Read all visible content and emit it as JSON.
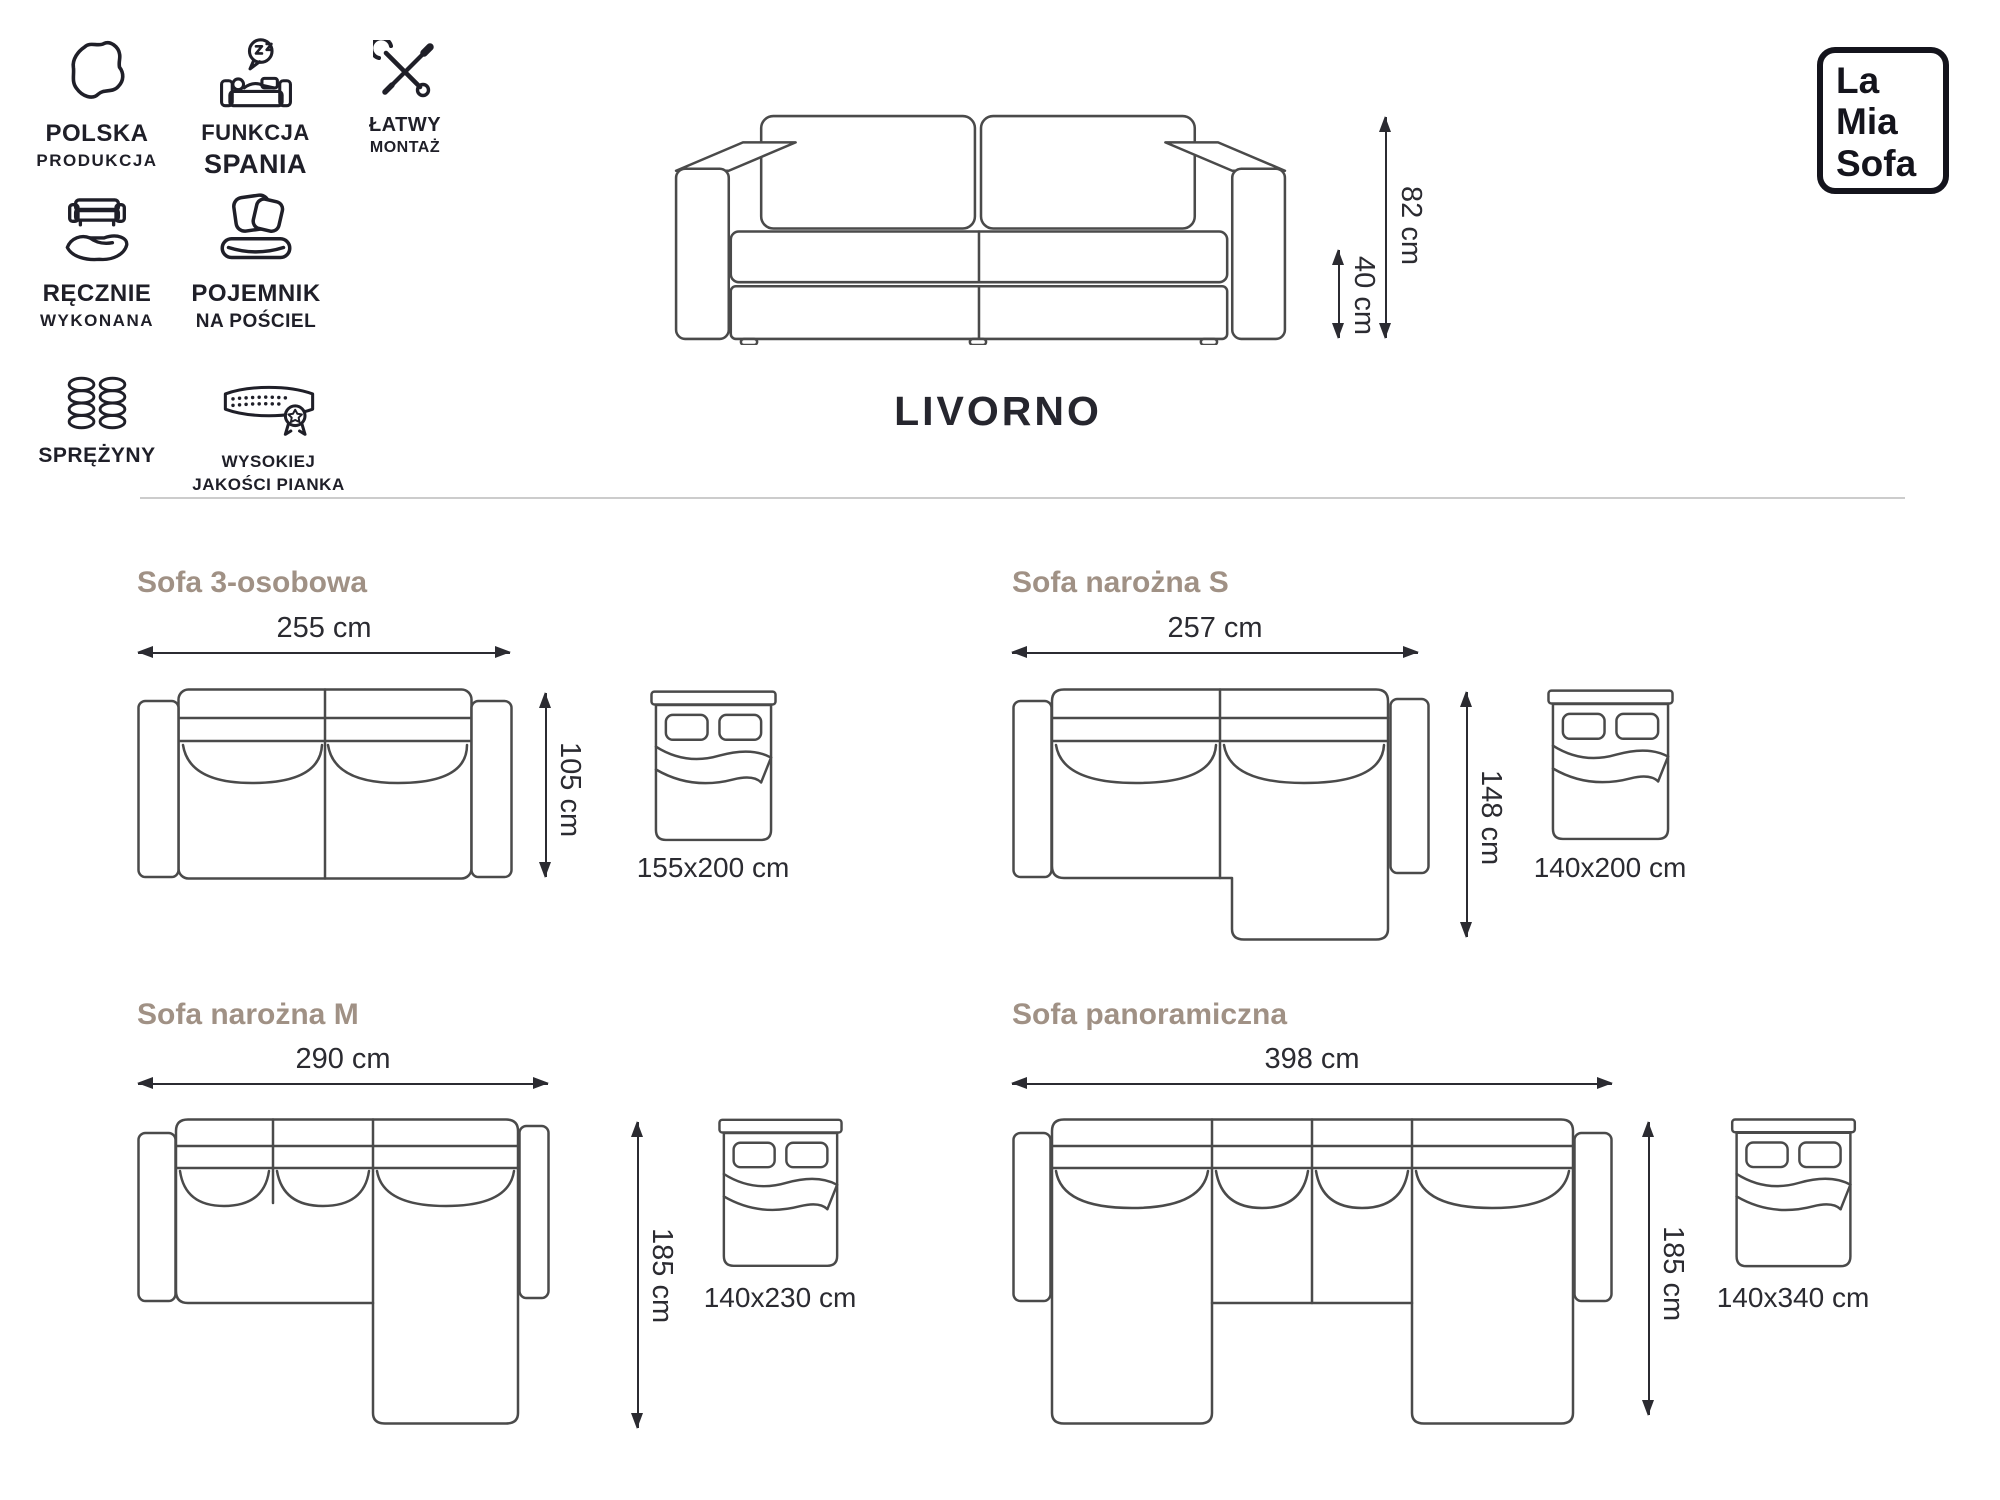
{
  "brand": {
    "line1": "La",
    "line2": "Mia",
    "line3": "Sofa"
  },
  "product": {
    "name": "LIVORNO"
  },
  "hero": {
    "total_height": "82 cm",
    "seat_height": "40 cm"
  },
  "features": [
    {
      "icon": "poland-map",
      "title": "POLSKA",
      "subtitle": "PRODUKCJA"
    },
    {
      "icon": "sleep-function",
      "title": "FUNKCJA",
      "subtitle": "SPANIA"
    },
    {
      "icon": "easy-assembly",
      "title": "ŁATWY",
      "subtitle": "MONTAŻ"
    },
    {
      "icon": "handmade",
      "title": "RĘCZNIE",
      "subtitle": "WYKONANA"
    },
    {
      "icon": "bedding-storage",
      "title": "POJEMNIK",
      "subtitle": "NA POŚCIEL"
    },
    {
      "icon": "springs",
      "title": "SPRĘŻYNY",
      "subtitle": ""
    },
    {
      "icon": "quality-foam",
      "title": "WYSOKIEJ",
      "subtitle": "JAKOŚCI PIANKA"
    }
  ],
  "variants": [
    {
      "name": "Sofa 3-osobowa",
      "width": "255 cm",
      "depth": "105 cm",
      "bed_size": "155x200 cm"
    },
    {
      "name": "Sofa narożna S",
      "width": "257 cm",
      "depth": "148 cm",
      "bed_size": "140x200 cm"
    },
    {
      "name": "Sofa narożna M",
      "width": "290 cm",
      "depth": "185 cm",
      "bed_size": "140x230 cm"
    },
    {
      "name": "Sofa panoramiczna",
      "width": "398 cm",
      "depth": "185 cm",
      "bed_size": "140x340 cm"
    }
  ],
  "colors": {
    "line": "#4a4a4a",
    "icon": "#1f1f28",
    "text": "#2b2b31",
    "heading": "#a09185",
    "divider": "#cccccc",
    "logo": "#14141c"
  }
}
